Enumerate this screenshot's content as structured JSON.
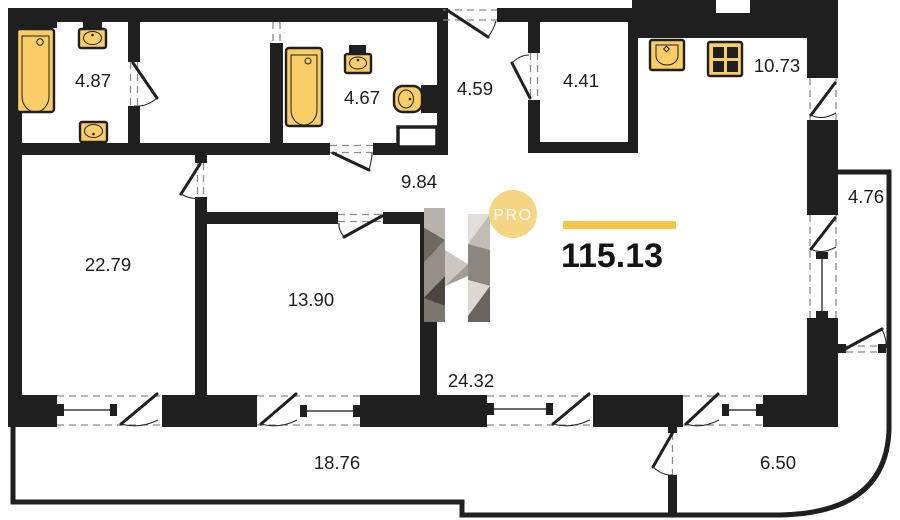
{
  "plan": {
    "badge_label": "PRO",
    "total_area": "115.13",
    "logo_letter": "H",
    "rooms": [
      {
        "id": "bathroom-1",
        "area": "4.87"
      },
      {
        "id": "bathroom-2",
        "area": "4.67"
      },
      {
        "id": "hall",
        "area": "4.59"
      },
      {
        "id": "wardrobe",
        "area": "4.41"
      },
      {
        "id": "kitchen",
        "area": "10.73"
      },
      {
        "id": "corridor",
        "area": "9.84"
      },
      {
        "id": "room-left",
        "area": "22.79"
      },
      {
        "id": "room-middle",
        "area": "13.90"
      },
      {
        "id": "living-area",
        "area": "24.32"
      },
      {
        "id": "loggia-right",
        "area": "4.76"
      },
      {
        "id": "loggia-bottom",
        "area": "18.76"
      },
      {
        "id": "loggia-corner",
        "area": "6.50"
      }
    ],
    "colors": {
      "wall": "#1f1f1f",
      "fixture": "#FACD69",
      "accent_bar": "#F5C54B",
      "badge": "#F6D584",
      "background": "#FFFFFF"
    },
    "icons": [
      "bathtub-icon",
      "sink-icon",
      "toilet-icon",
      "stove-icon",
      "kitchen-sink-icon",
      "door-swing-icon",
      "window-icon",
      "shaft-icon",
      "h-logo",
      "pro-badge"
    ]
  }
}
